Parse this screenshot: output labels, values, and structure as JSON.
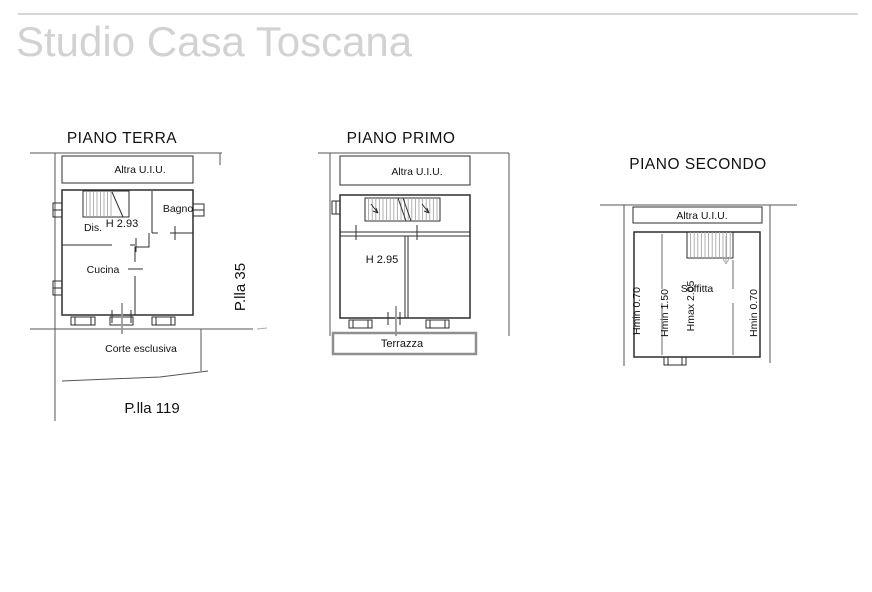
{
  "watermark": "Studio Casa Toscana",
  "colors": {
    "wall": "#2e2e2e",
    "boundary": "#555555",
    "gray_line": "#9a9a9a",
    "stair_hatch": "#a8a8a8",
    "height_line": "#b5b5b5",
    "terrace_border": "#8f8f8f",
    "letterhead_rule": "#c9c9c9",
    "watermark_gray": "#d2d2d2",
    "paper": "#ffffff"
  },
  "plans": {
    "terra": {
      "title": "PIANO TERRA",
      "altra_uiu": "Altra U.I.U.",
      "bagno": "Bagno",
      "dis": "Dis.",
      "height": "H 2.93",
      "cucina": "Cucina",
      "corte": "Corte esclusiva",
      "parcel_side": "P.lla 35",
      "parcel_below": "P.lla 119"
    },
    "primo": {
      "title": "PIANO PRIMO",
      "altra_uiu": "Altra U.I.U.",
      "height": "H 2.95",
      "terrazza": "Terrazza"
    },
    "secondo": {
      "title": "PIANO SECONDO",
      "altra_uiu": "Altra U.I.U.",
      "soffitta": "Soffitta",
      "hmin_left": "Hmin 0.70",
      "hmin_center": "Hmin 1.50",
      "hmax_center": "Hmax 2.05",
      "hmin_right": "Hmin 0.70"
    }
  }
}
